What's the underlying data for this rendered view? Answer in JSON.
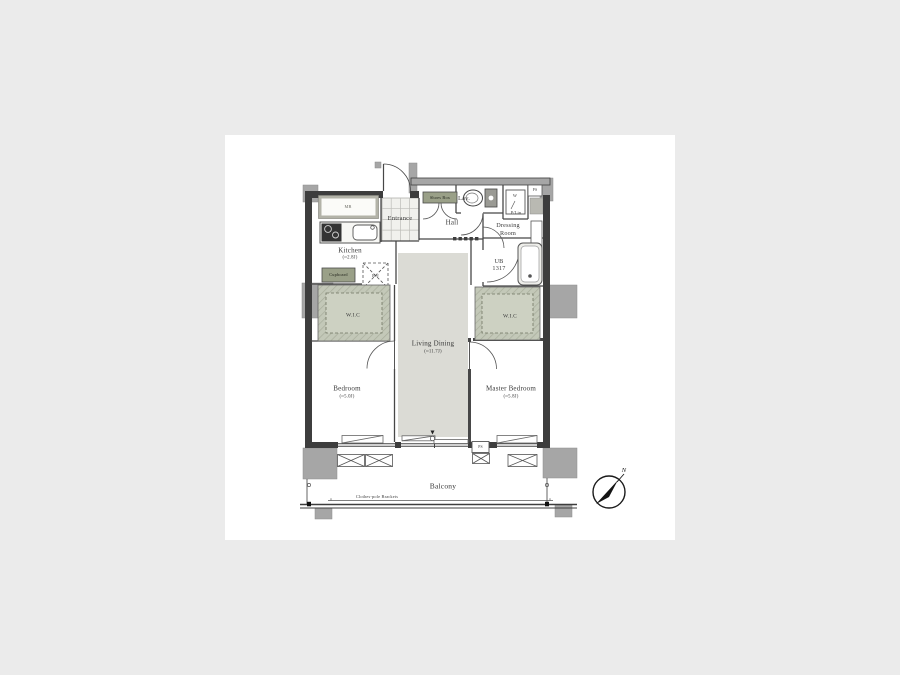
{
  "plan": {
    "rooms": {
      "entrance": "Entrance",
      "hall": "Hall",
      "lav": "Lav.",
      "dressing_line1": "Dressing",
      "dressing_line2": "Room",
      "ub_line1": "UB",
      "ub_line2": "1317",
      "kitchen": "Kitchen",
      "kitchen_size": "(≈2.8J)",
      "living_dining": "Living Dining",
      "living_dining_size": "(≈11.7J)",
      "bedroom": "Bedroom",
      "bedroom_size": "(≈5.0J)",
      "master_bedroom": "Master Bedroom",
      "master_bedroom_size": "(≈5.8J)",
      "wic_left": "W.I.C",
      "wic_right": "W.I.C",
      "balcony": "Balcony"
    },
    "fixtures": {
      "mb": "MB",
      "shoes_box": "Shoes Box",
      "washer": "W",
      "p_lin": "P/Lin",
      "ps_top": "PS",
      "ps_bottom": "PS",
      "cupboard": "Cupboard",
      "ref": "Ref",
      "clothes_pole": "Clothes-pole Brackets"
    },
    "compass": {
      "north": "N"
    },
    "colors": {
      "background": "#ebebeb",
      "sheet": "#ffffff",
      "wall": "#3d3d3d",
      "column_gray": "#a6a6a6",
      "living_floor": "#dbdbd5",
      "closet_green": "#9aa088",
      "wic_hatch": "#c3c8b8"
    }
  }
}
